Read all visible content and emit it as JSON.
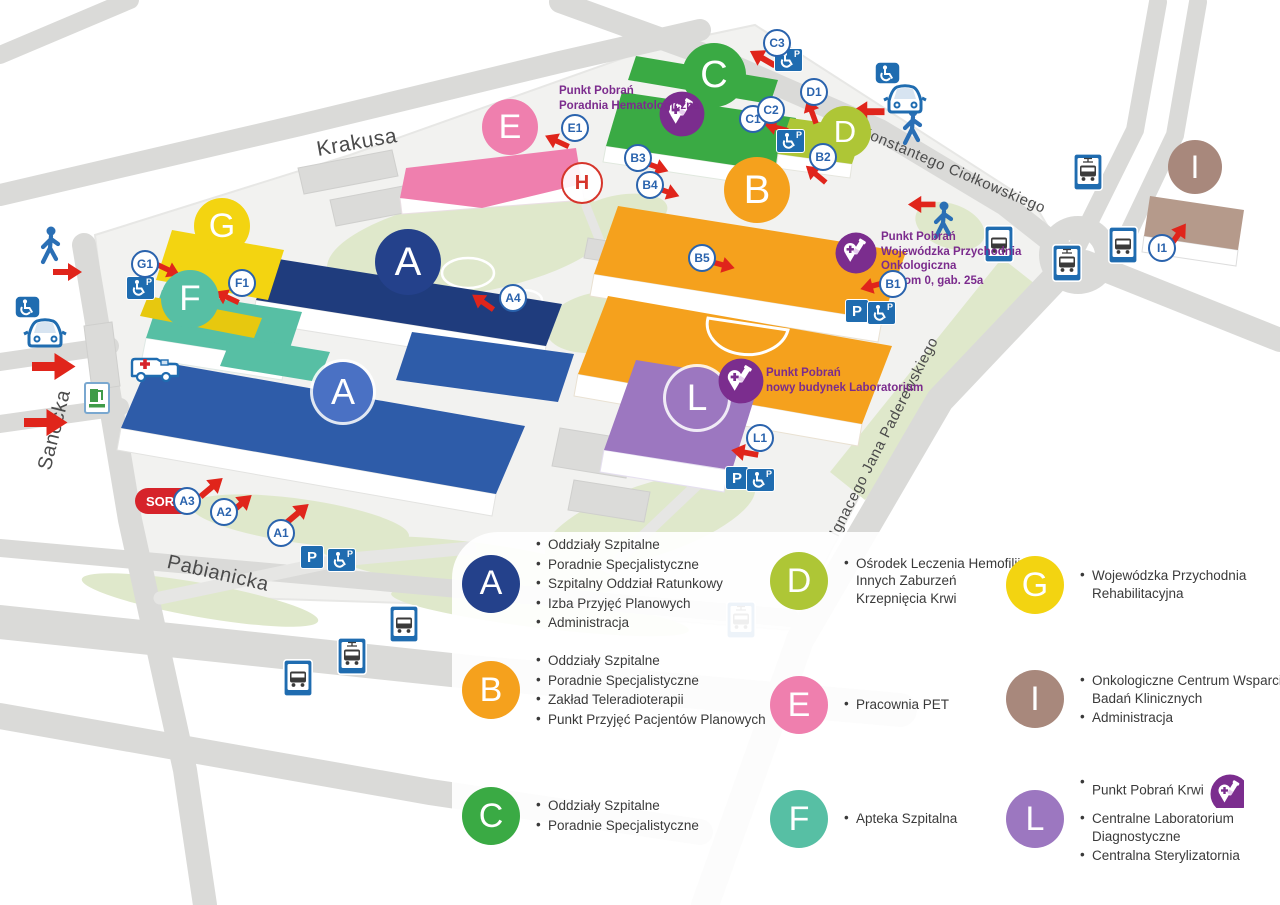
{
  "map": {
    "streets": [
      {
        "name": "Krakusa",
        "x": 357,
        "y": 143,
        "angle": -10,
        "size": 21
      },
      {
        "name": "Konstantego  Ciołkowskiego",
        "x": 953,
        "y": 170,
        "angle": 23,
        "size": 15
      },
      {
        "name": "Sanocka",
        "x": 55,
        "y": 430,
        "angle": -76,
        "size": 20
      },
      {
        "name": "Pabianicka",
        "x": 218,
        "y": 574,
        "angle": 13,
        "size": 20
      },
      {
        "name": "Ignacego Jana Paderewskiego",
        "x": 884,
        "y": 437,
        "angle": -63,
        "size": 15
      }
    ],
    "building_labels": [
      {
        "letter": "A",
        "x": 408,
        "y": 262,
        "d": 66,
        "color": "#24418b",
        "ring": false
      },
      {
        "letter": "A",
        "x": 343,
        "y": 392,
        "d": 60,
        "color": "#4a71c4",
        "ring": true
      },
      {
        "letter": "B",
        "x": 757,
        "y": 190,
        "d": 66,
        "color": "#f5a11d",
        "ring": false
      },
      {
        "letter": "C",
        "x": 714,
        "y": 75,
        "d": 64,
        "color": "#3aaa44",
        "ring": false
      },
      {
        "letter": "D",
        "x": 845,
        "y": 132,
        "d": 52,
        "color": "#aec636",
        "ring": false
      },
      {
        "letter": "E",
        "x": 510,
        "y": 127,
        "d": 56,
        "color": "#ef7fae",
        "ring": false
      },
      {
        "letter": "F",
        "x": 190,
        "y": 299,
        "d": 58,
        "color": "#57bfa4",
        "ring": false
      },
      {
        "letter": "G",
        "x": 222,
        "y": 226,
        "d": 56,
        "color": "#f3d411",
        "ring": false
      },
      {
        "letter": "I",
        "x": 1195,
        "y": 167,
        "d": 54,
        "color": "#a8887c",
        "ring": false
      },
      {
        "letter": "L",
        "x": 697,
        "y": 398,
        "d": 62,
        "color": "#9c77c0",
        "ring": true
      }
    ],
    "entrances": [
      {
        "label": "A1",
        "x": 281,
        "y": 533
      },
      {
        "label": "A2",
        "x": 224,
        "y": 512
      },
      {
        "label": "A3",
        "x": 187,
        "y": 501
      },
      {
        "label": "A4",
        "x": 513,
        "y": 298
      },
      {
        "label": "B1",
        "x": 893,
        "y": 284
      },
      {
        "label": "B2",
        "x": 823,
        "y": 157
      },
      {
        "label": "B3",
        "x": 638,
        "y": 158
      },
      {
        "label": "B4",
        "x": 650,
        "y": 185
      },
      {
        "label": "B5",
        "x": 702,
        "y": 258
      },
      {
        "label": "C1",
        "x": 753,
        "y": 119
      },
      {
        "label": "C2",
        "x": 771,
        "y": 110
      },
      {
        "label": "C3",
        "x": 777,
        "y": 43
      },
      {
        "label": "D1",
        "x": 814,
        "y": 92
      },
      {
        "label": "E1",
        "x": 575,
        "y": 128
      },
      {
        "label": "F1",
        "x": 242,
        "y": 283
      },
      {
        "label": "G1",
        "x": 145,
        "y": 264
      },
      {
        "label": "I1",
        "x": 1162,
        "y": 248
      },
      {
        "label": "L1",
        "x": 760,
        "y": 438
      }
    ],
    "sor_label": "SOR",
    "parking_letter": "P",
    "helipad_letter": "H",
    "blood_notes": [
      {
        "x": 559,
        "y": 84,
        "lines": [
          "Punkt Pobrań",
          "Poradnia Hematologiczna"
        ],
        "icon_x": 682,
        "icon_y": 114,
        "icon_d": 46
      },
      {
        "x": 881,
        "y": 230,
        "lines": [
          "Punkt Pobrań",
          "Wojewódzka Przychodnia",
          "Onkologiczna",
          "poziom 0, gab. 25a"
        ],
        "icon_x": 856,
        "icon_y": 253,
        "icon_d": 42
      },
      {
        "x": 766,
        "y": 366,
        "lines": [
          "Punkt Pobrań",
          "nowy budynek Laboratorium"
        ],
        "icon_x": 741,
        "icon_y": 381,
        "icon_d": 46
      }
    ],
    "transit_stops": [
      {
        "kind": "tram",
        "x": 1088,
        "y": 172
      },
      {
        "kind": "bus",
        "x": 999,
        "y": 244
      },
      {
        "kind": "tram",
        "x": 1067,
        "y": 263
      },
      {
        "kind": "bus",
        "x": 1123,
        "y": 245
      },
      {
        "kind": "bus",
        "x": 404,
        "y": 624
      },
      {
        "kind": "tram",
        "x": 352,
        "y": 656
      },
      {
        "kind": "bus",
        "x": 298,
        "y": 678
      },
      {
        "kind": "tram",
        "x": 741,
        "y": 620
      }
    ],
    "parking": [
      {
        "x": 788,
        "y": 60,
        "kind": "disabled"
      },
      {
        "x": 790,
        "y": 141,
        "kind": "disabled"
      },
      {
        "x": 140,
        "y": 288,
        "kind": "disabled"
      },
      {
        "x": 857,
        "y": 311,
        "kind": "p"
      },
      {
        "x": 881,
        "y": 313,
        "kind": "disabled"
      },
      {
        "x": 737,
        "y": 478,
        "kind": "p"
      },
      {
        "x": 760,
        "y": 480,
        "kind": "disabled"
      },
      {
        "x": 312,
        "y": 557,
        "kind": "p"
      },
      {
        "x": 341,
        "y": 560,
        "kind": "disabled"
      }
    ],
    "arrows": [
      {
        "x": 68,
        "y": 272,
        "r": 0,
        "s": 1
      },
      {
        "x": 54,
        "y": 366,
        "r": 0,
        "s": 1.5
      },
      {
        "x": 46,
        "y": 422,
        "r": 0,
        "s": 1.5
      },
      {
        "x": 212,
        "y": 487,
        "r": -40,
        "s": 1
      },
      {
        "x": 241,
        "y": 504,
        "r": -40,
        "s": 1
      },
      {
        "x": 298,
        "y": 513,
        "r": -40,
        "s": 1
      },
      {
        "x": 168,
        "y": 270,
        "r": 25,
        "s": 0.9
      },
      {
        "x": 226,
        "y": 297,
        "r": 205,
        "s": 0.9
      },
      {
        "x": 482,
        "y": 302,
        "r": 215,
        "s": 0.9
      },
      {
        "x": 556,
        "y": 141,
        "r": 205,
        "s": 0.9
      },
      {
        "x": 762,
        "y": 58,
        "r": 210,
        "s": 1
      },
      {
        "x": 776,
        "y": 127,
        "r": 195,
        "s": 0.85
      },
      {
        "x": 811,
        "y": 111,
        "r": 250,
        "s": 0.9
      },
      {
        "x": 815,
        "y": 174,
        "r": 220,
        "s": 0.9
      },
      {
        "x": 656,
        "y": 167,
        "r": 20,
        "s": 0.9
      },
      {
        "x": 667,
        "y": 192,
        "r": 20,
        "s": 0.9
      },
      {
        "x": 722,
        "y": 265,
        "r": 15,
        "s": 0.9
      },
      {
        "x": 872,
        "y": 286,
        "r": 165,
        "s": 0.9
      },
      {
        "x": 867,
        "y": 112,
        "r": 180,
        "s": 1.15
      },
      {
        "x": 921,
        "y": 204,
        "r": 180,
        "s": 0.95
      },
      {
        "x": 744,
        "y": 452,
        "r": 190,
        "s": 0.95
      },
      {
        "x": 1178,
        "y": 234,
        "r": -55,
        "s": 0.95
      }
    ],
    "icons": [
      {
        "kind": "pedestrian",
        "x": 50,
        "y": 247
      },
      {
        "kind": "pedestrian",
        "x": 912,
        "y": 128
      },
      {
        "kind": "pedestrian",
        "x": 943,
        "y": 222
      },
      {
        "kind": "disabled-car",
        "x": 44,
        "y": 322
      },
      {
        "kind": "disabled-car",
        "x": 904,
        "y": 88
      },
      {
        "kind": "ambulance",
        "x": 154,
        "y": 367
      },
      {
        "kind": "fuel",
        "x": 97,
        "y": 398
      },
      {
        "kind": "helipad",
        "x": 580,
        "y": 181
      }
    ]
  },
  "legend": {
    "columns": [
      {
        "left": 462,
        "width": 250,
        "tops": [
          534,
          650,
          787
        ],
        "entries": [
          {
            "letter": "A",
            "color": "#24418b",
            "items": [
              "Oddziały Szpitalne",
              "Poradnie Specjalistyczne",
              "Szpitalny Oddział Ratunkowy",
              "Izba Przyjęć Planowych",
              "Administracja"
            ]
          },
          {
            "letter": "B",
            "color": "#f5a11d",
            "items": [
              "Oddziały Szpitalne",
              "Poradnie Specjalistyczne",
              "Zakład Teleradioterapii",
              "Punkt Przyjęć Pacjentów Planowych"
            ]
          },
          {
            "letter": "C",
            "color": "#3aaa44",
            "items": [
              "Oddziały Szpitalne",
              "Poradnie Specjalistyczne"
            ]
          }
        ]
      },
      {
        "left": 770,
        "width": 185,
        "tops": [
          552,
          676,
          790
        ],
        "entries": [
          {
            "letter": "D",
            "color": "#aec636",
            "items": [
              "Ośrodek Leczenia Hemofilii i Innych Zaburzeń Krzepnięcia Krwi"
            ]
          },
          {
            "letter": "E",
            "color": "#ef7fae",
            "items": [
              "Pracownia PET"
            ]
          },
          {
            "letter": "F",
            "color": "#57bfa4",
            "items": [
              "Apteka Szpitalna"
            ]
          }
        ]
      },
      {
        "left": 1006,
        "width": 230,
        "tops": [
          556,
          670,
          772
        ],
        "entries": [
          {
            "letter": "G",
            "color": "#f3d411",
            "items": [
              "Wojewódzka Przychodnia Rehabilitacyjna"
            ]
          },
          {
            "letter": "I",
            "color": "#a8887c",
            "items": [
              "Onkologiczne Centrum Wsparcia Badań Klinicznych",
              "Administracja"
            ]
          },
          {
            "letter": "L",
            "color": "#9c77c0",
            "items": [
              "Punkt Pobrań Krwi",
              "Centralne Laboratorium Diagnostyczne",
              "Centralna Sterylizatornia"
            ],
            "icon": "blood"
          }
        ]
      }
    ]
  },
  "colors": {
    "road": "#dadad8",
    "ground": "#f2f2f0",
    "green": "#dfe8cb",
    "accent_red": "#e0251b",
    "entrance_blue": "#2a63ad",
    "transit_blue": "#1f6cb0",
    "blood_purple": "#7b2d8e"
  }
}
